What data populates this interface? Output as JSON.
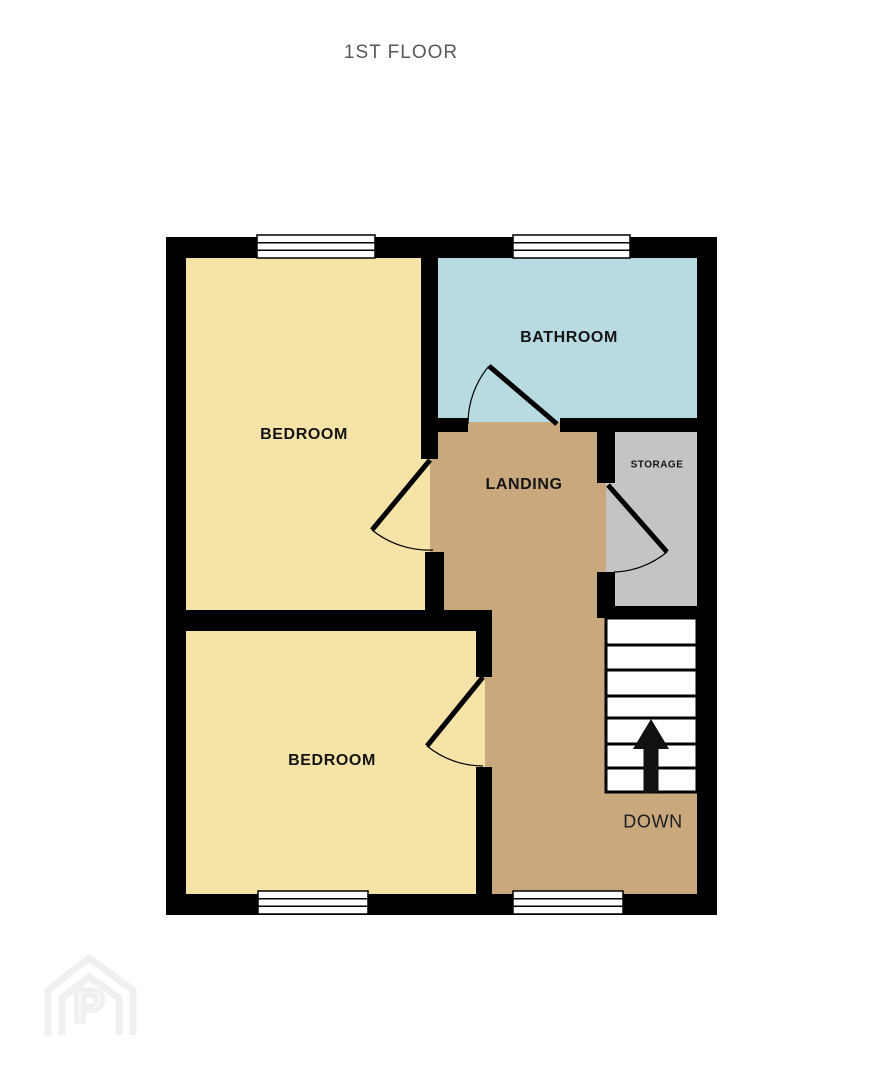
{
  "title": "1ST FLOOR",
  "rooms": [
    {
      "id": "bedroom-1",
      "label": "BEDROOM"
    },
    {
      "id": "bathroom",
      "label": "BATHROOM"
    },
    {
      "id": "landing",
      "label": "LANDING"
    },
    {
      "id": "storage",
      "label": "STORAGE"
    },
    {
      "id": "bedroom-2",
      "label": "BEDROOM"
    }
  ],
  "stairs": {
    "label": "DOWN",
    "direction": "up-arrow",
    "treads": 7
  },
  "watermark": {
    "letter": "P"
  },
  "colors": {
    "bedroom_fill": "#F6E3A7",
    "bathroom_fill": "#B8DBE2",
    "landing_fill": "#C9A87E",
    "storage_fill": "#C4C4C2",
    "wall": "#000000",
    "window_fill": "#FFFFFF",
    "title_text": "#59595B",
    "label_text": "#141414",
    "watermark": "#F0F0F0"
  }
}
